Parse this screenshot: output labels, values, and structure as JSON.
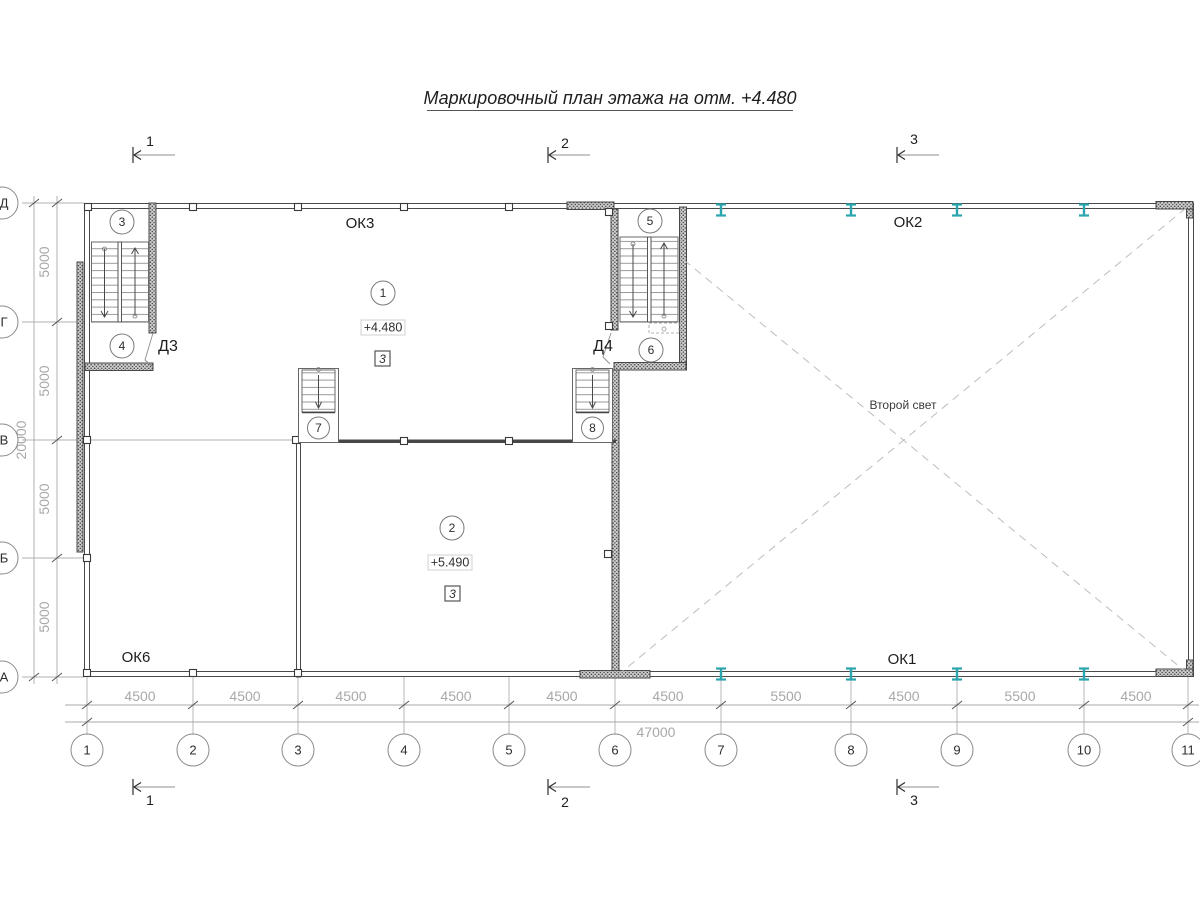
{
  "title": "Маркировочный план этажа на отм. +4.480",
  "grid": {
    "columns": [
      "1",
      "2",
      "3",
      "4",
      "5",
      "6",
      "7",
      "8",
      "9",
      "10",
      "11"
    ],
    "rows": [
      "Д",
      "Г",
      "В",
      "Б",
      "А"
    ],
    "column_dims": [
      "4500",
      "4500",
      "4500",
      "4500",
      "4500",
      "4500",
      "5500",
      "4500",
      "5500",
      "4500"
    ],
    "row_dims": [
      "5000",
      "5000",
      "5000",
      "5000"
    ],
    "total_width": "47000",
    "total_depth": "20000"
  },
  "section_marks": {
    "s1": "1",
    "s2": "2",
    "s3": "3"
  },
  "windows": {
    "ok3": "ОК3",
    "ok2": "ОК2",
    "ok6": "ОК6",
    "ok1": "ОК1"
  },
  "doors": {
    "d3": "Д3",
    "d4": "Д4"
  },
  "rooms": {
    "r1": "1",
    "r2": "2",
    "r3": "3",
    "r4": "4",
    "r5": "5",
    "r6": "6",
    "r7": "7",
    "r8": "8"
  },
  "elevations": {
    "room1": "+4.480",
    "room2": "+5.490"
  },
  "layout_marks": {
    "room1": "3",
    "room2": "3"
  },
  "void_label": "Второй свет",
  "colors": {
    "steel_column": "#2aa5ad",
    "wall_line": "#474747",
    "dim_text": "#a8a8a8"
  }
}
